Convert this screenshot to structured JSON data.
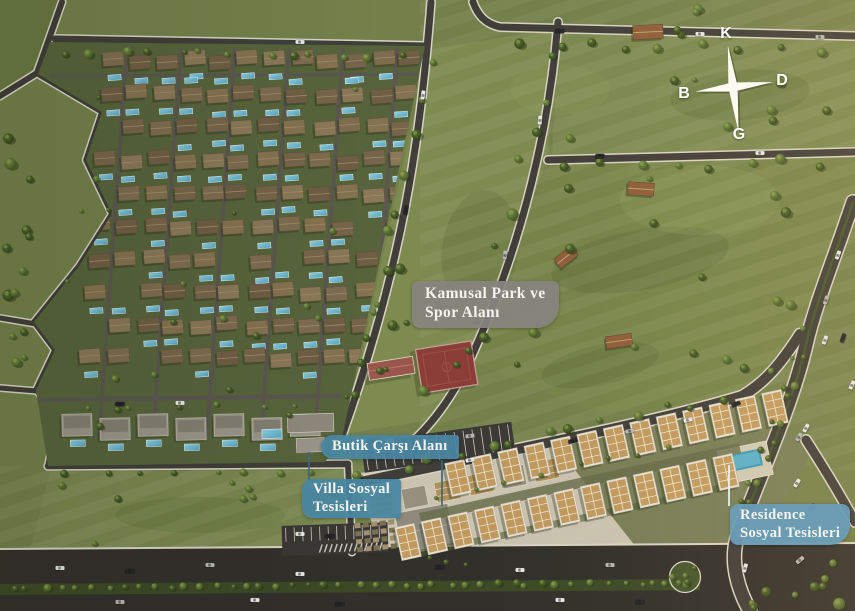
{
  "labels": {
    "kamusal_park": {
      "line1": "Kamusal Park ve",
      "line2": "Spor Alanı"
    },
    "butik_carsi": {
      "text": "Butik Çarşı Alanı"
    },
    "villa_sosyal": {
      "line1": "Villa Sosyal",
      "line2": "Tesisleri"
    },
    "residence_sosyal": {
      "line1": "Residence",
      "line2": "Sosyal Tesisleri"
    }
  },
  "compass": {
    "north": "K",
    "east": "D",
    "south": "G",
    "west": "B"
  },
  "colors": {
    "grass_base": "#74814B",
    "grass_dark": "#5F6F3A",
    "grass_light": "#8A9758",
    "road": "#403E39",
    "road_edge": "#D8D4C4",
    "villa_lawn": "#57643B",
    "villa_roof_brown": "#7E6C4F",
    "pool_blue": "#72B7CF",
    "residence_roof_tan": "#C19A5F",
    "residence_wall": "#E7E2D5",
    "court_red": "#8B3E36",
    "plaza_paving": "#CBC4B1",
    "label_gray": "rgba(133,132,126,0.93)",
    "label_teal": "rgba(72,134,161,0.94)",
    "label_teal_light": "rgba(106,157,182,0.95)",
    "compass_white": "#FDFDFB"
  }
}
